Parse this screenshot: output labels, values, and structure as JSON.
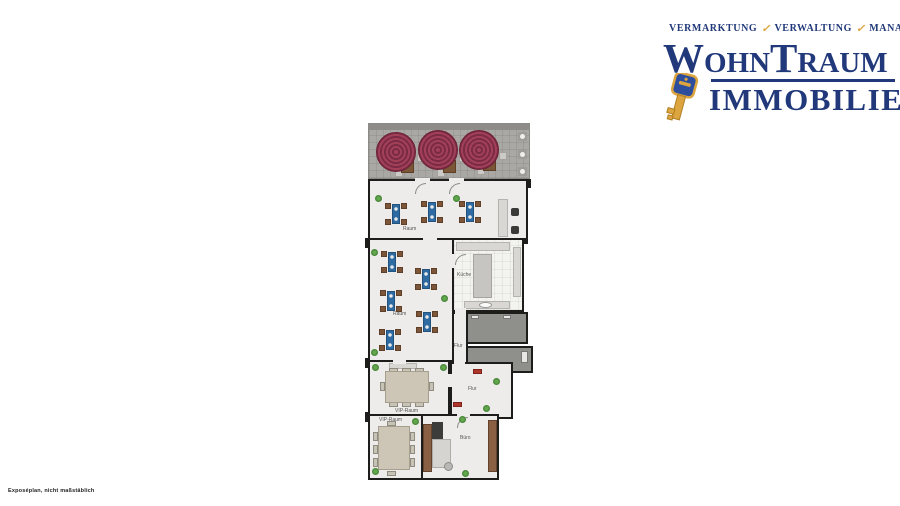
{
  "logo": {
    "tagline": {
      "items": [
        "VERMARKTUNG",
        "VERWALTUNG",
        "MANAGEMENT"
      ],
      "check": "✓"
    },
    "name_line1": "WohnTraum",
    "name_line2": "IMMOBILIEN",
    "colors": {
      "navy": "#21397a",
      "gold": "#dca53f"
    }
  },
  "floor_plan": {
    "rooms": {
      "raum1": {
        "label": "Raum"
      },
      "raum2": {
        "label": "Raum"
      },
      "kueche": {
        "label": "Küche"
      },
      "flur1": {
        "label": "Flur"
      },
      "flur2": {
        "label": "Flur"
      },
      "vip1": {
        "label": "VIP-Raum"
      },
      "vip2": {
        "label": "VIP-Raum"
      },
      "buero": {
        "label": "Büro"
      }
    },
    "colors": {
      "wall": "#1d1d1b",
      "floor": "#edecea",
      "terrace": "#a9a8a4",
      "parasol": "#8e3150",
      "table_blue": "#2f6ba3",
      "chair_brown": "#7d5639",
      "plant_green": "#4a8f3c",
      "accent_red": "#ad352a",
      "dark_room": "#8f8f8c",
      "wood_brown": "#8a6044"
    }
  },
  "footer": {
    "disclaimer": "Exposéplan, nicht maßstäblich"
  }
}
